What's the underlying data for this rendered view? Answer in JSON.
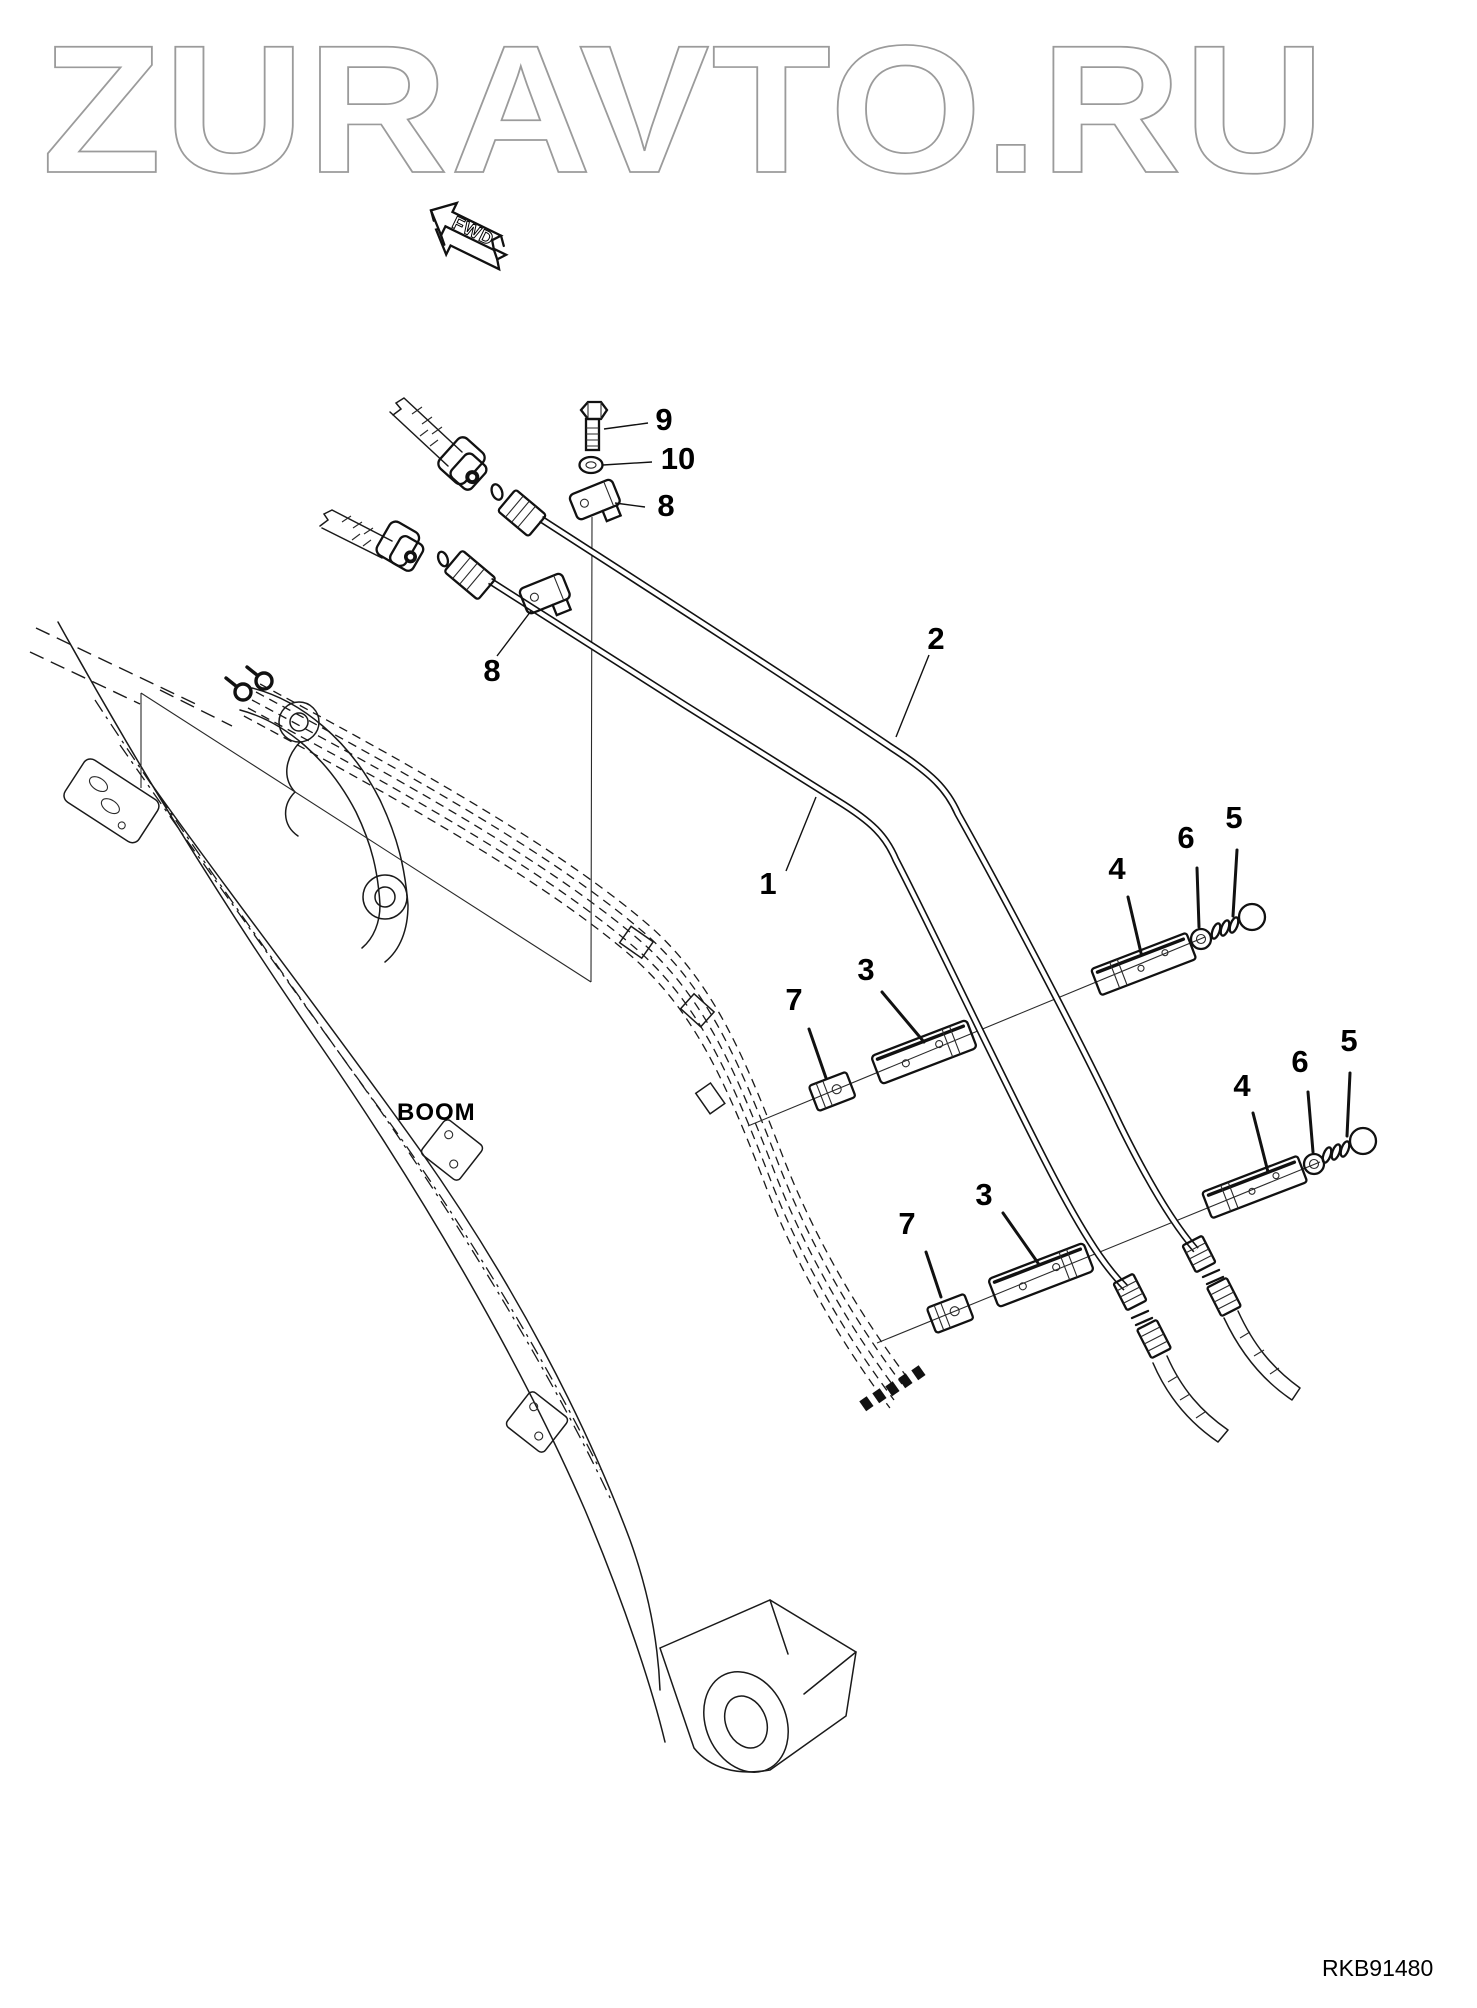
{
  "watermark": {
    "text": "ZURAVTO.RU"
  },
  "fwd_arrow": {
    "text": "FWD"
  },
  "labels": {
    "boom": "BOOM",
    "drawing_number": "RKB91480"
  },
  "colors": {
    "background": "#ffffff",
    "line": "#1a1a1a",
    "watermark_outline": "#9b9b9b"
  },
  "callouts": [
    {
      "part": "mount-bolt",
      "label": "9"
    },
    {
      "part": "washer",
      "label": "10"
    },
    {
      "part": "clamp-plate-upper",
      "label": "8"
    },
    {
      "part": "clamp-plate-lower",
      "label": "8"
    },
    {
      "part": "pipe-right",
      "label": "2"
    },
    {
      "part": "pipe-left",
      "label": "1"
    },
    {
      "part": "clamp-bar-upper",
      "label": "4"
    },
    {
      "part": "grommet-upper",
      "label": "6"
    },
    {
      "part": "clamp-bolt-upper",
      "label": "5"
    },
    {
      "part": "clamp-half-upper",
      "label": "3"
    },
    {
      "part": "clamp-block-upper",
      "label": "7"
    },
    {
      "part": "clamp-bar-lower",
      "label": "4"
    },
    {
      "part": "grommet-lower",
      "label": "6"
    },
    {
      "part": "clamp-bolt-lower",
      "label": "5"
    },
    {
      "part": "clamp-half-lower",
      "label": "3"
    },
    {
      "part": "clamp-block-lower",
      "label": "7"
    }
  ]
}
